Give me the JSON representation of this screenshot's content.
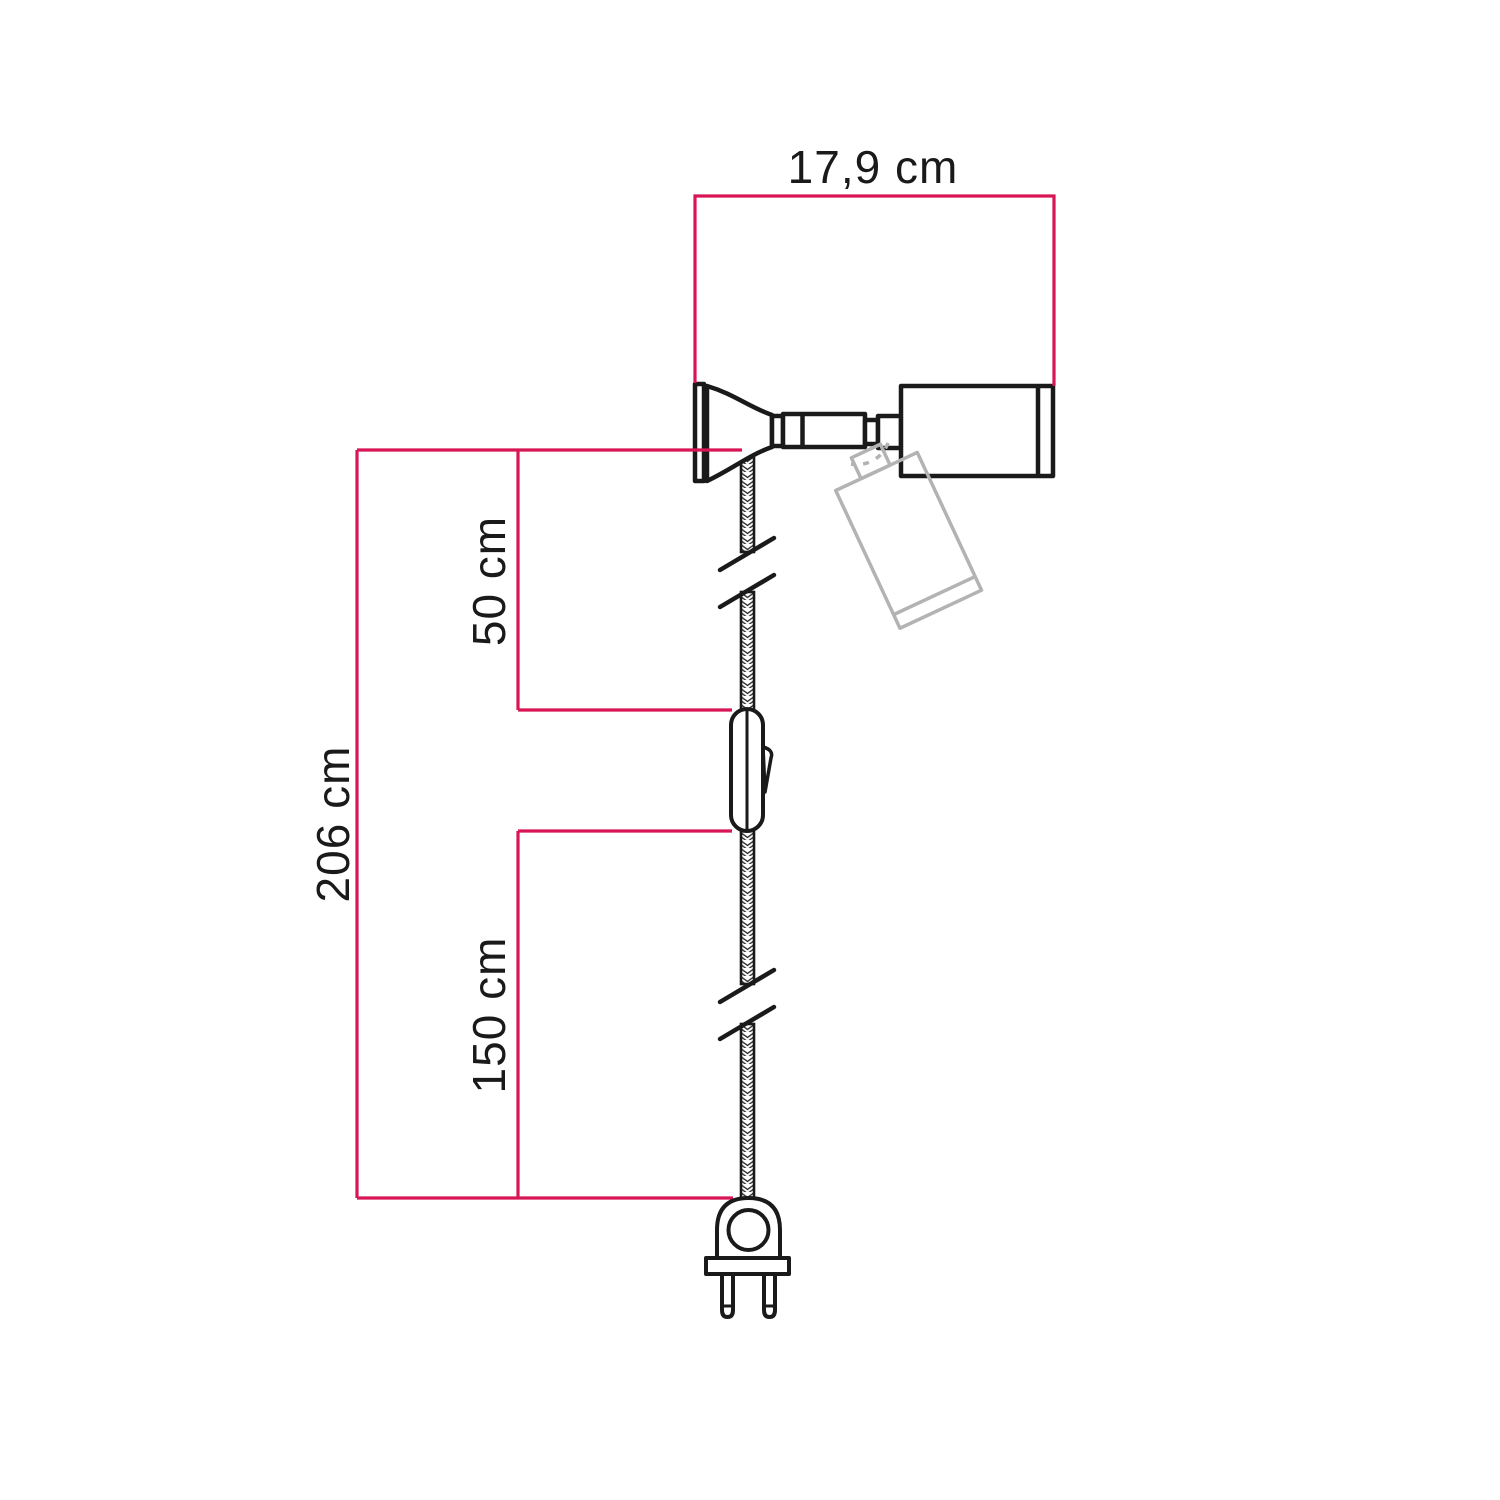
{
  "diagram": {
    "type": "product-dimension-diagram",
    "product": "adjustable spotlight wall lamp with textile cable, inline switch and two-pin plug",
    "dimensions": {
      "head_width": "17,9 cm",
      "cable_lamp_to_switch": "50 cm",
      "total_length": "206 cm",
      "cable_switch_to_plug": "150 cm"
    },
    "colors": {
      "dimension_line": "#d81555",
      "outline": "#1a1a1a",
      "ghost_outline": "#b3b3b3",
      "background": "#ffffff"
    },
    "components": [
      "wall-plate",
      "bell-base",
      "swivel-joint",
      "spotlight-head",
      "ghost-rotated-spotlight-head",
      "braided-cable",
      "cable-break-marks",
      "inline-switch",
      "two-pin-plug"
    ]
  }
}
